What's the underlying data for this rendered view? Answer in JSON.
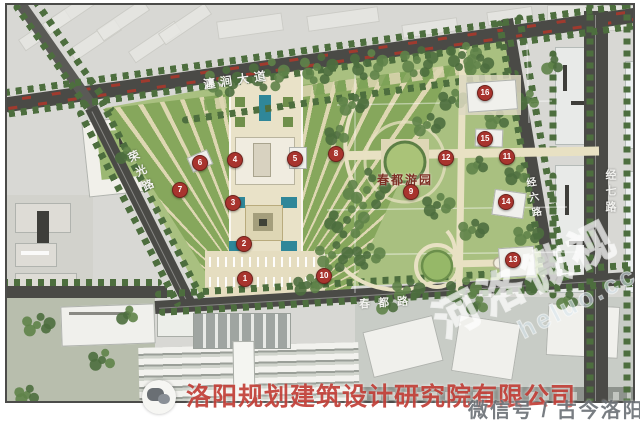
{
  "roads": {
    "chanjian_avenue": "瀍涧大道",
    "rongguang_road": "荣光路",
    "chundu_road": "春都路",
    "jing6_road": "经六路",
    "jing7_road": "经七路"
  },
  "park": {
    "name": "春都游园"
  },
  "marker_color": "#a8342e",
  "markers": [
    {
      "n": "1",
      "x": 237,
      "y": 273
    },
    {
      "n": "2",
      "x": 236,
      "y": 238
    },
    {
      "n": "3",
      "x": 225,
      "y": 197
    },
    {
      "n": "4",
      "x": 227,
      "y": 154
    },
    {
      "n": "5",
      "x": 287,
      "y": 153
    },
    {
      "n": "6",
      "x": 192,
      "y": 157
    },
    {
      "n": "7",
      "x": 172,
      "y": 184
    },
    {
      "n": "8",
      "x": 328,
      "y": 148
    },
    {
      "n": "9",
      "x": 403,
      "y": 186
    },
    {
      "n": "10",
      "x": 316,
      "y": 270
    },
    {
      "n": "11",
      "x": 499,
      "y": 151
    },
    {
      "n": "12",
      "x": 438,
      "y": 152
    },
    {
      "n": "13",
      "x": 505,
      "y": 254
    },
    {
      "n": "14",
      "x": 498,
      "y": 196
    },
    {
      "n": "15",
      "x": 477,
      "y": 133
    },
    {
      "n": "16",
      "x": 477,
      "y": 87
    }
  ],
  "watermark": {
    "company": "洛阳规划建筑设计研究院有限公司",
    "wechat_label": "微信号 / 古今洛阳",
    "diagonal_text": "河洛微视",
    "diagonal_sub": "heluo.cc",
    "wechat_icon": "wechat-icon"
  },
  "colors": {
    "road": "#4a4a46",
    "park_green": "#a9c080",
    "plaza_cream": "#ded7b2",
    "tree_dark": "#4d6e3e",
    "marker_red": "#a8342e",
    "teal_structure": "#2f8799",
    "frame": "#4c4c4a"
  }
}
